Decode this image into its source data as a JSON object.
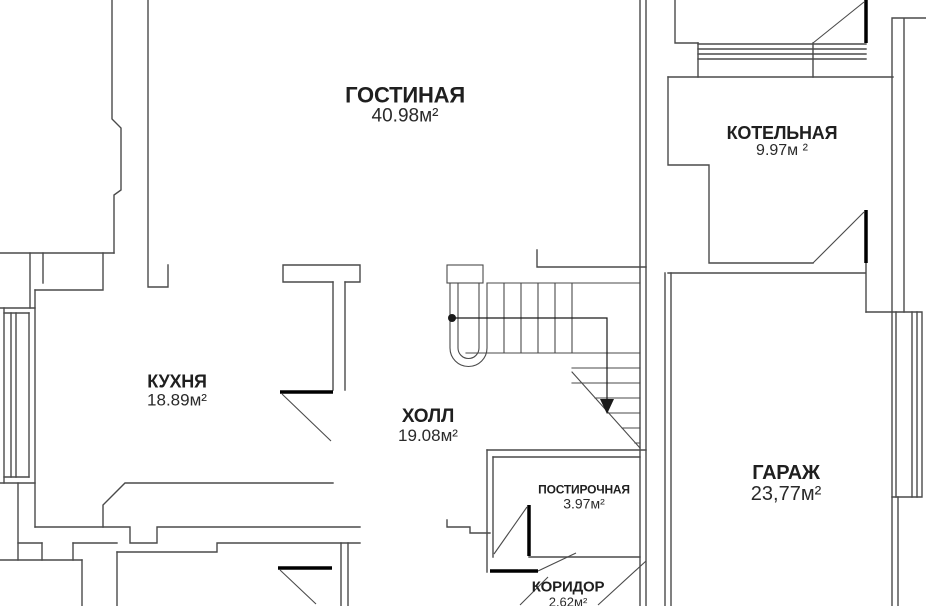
{
  "plan": {
    "background_color": "#ffffff",
    "wall_color": "#4a4a4a",
    "door_leaf_color": "#000000",
    "text_color": "#1f1f1f"
  },
  "rooms": [
    {
      "id": "living-room",
      "name": "ГОСТИНАЯ",
      "area": "40.98м²"
    },
    {
      "id": "boiler-room",
      "name": "КОТЕЛЬНАЯ",
      "area": "9.97м ²"
    },
    {
      "id": "kitchen",
      "name": "КУХНЯ",
      "area": "18.89м²"
    },
    {
      "id": "hall",
      "name": "ХОЛЛ",
      "area": "19.08м²"
    },
    {
      "id": "laundry",
      "name": "ПОСТИРОЧНАЯ",
      "area": "3.97м²"
    },
    {
      "id": "garage",
      "name": "ГАРАЖ",
      "area": "23,77м²"
    },
    {
      "id": "corridor",
      "name": "КОРИДОР",
      "area": "2.62м²"
    }
  ]
}
